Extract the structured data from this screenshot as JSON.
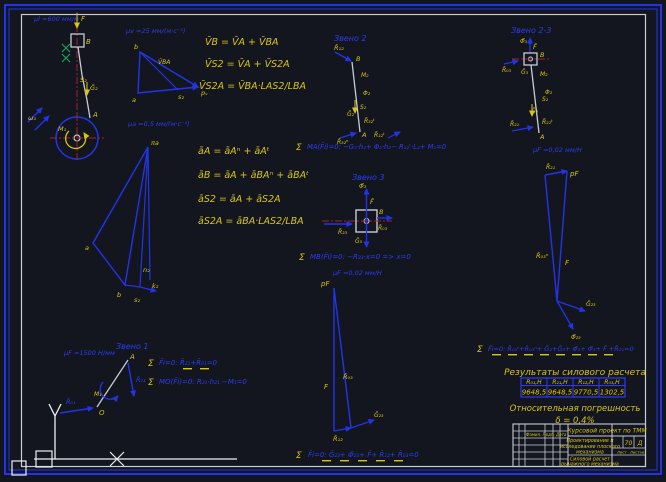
{
  "app": {
    "background": "#13161f",
    "accent_blue": "#2d3cf2",
    "accent_yellow": "#d9c41a"
  },
  "scales": {
    "mech": "μl =600 мм/м",
    "vel": "μv =25 мм/(м·с⁻¹)",
    "acc": "μa =0,5 мм/(м·с⁻²)",
    "link23": "μF =0,02 мм/Н",
    "poly23": "μF =0,02 мм/Н",
    "link1": "μF =1500 Н/мм"
  },
  "titles": {
    "link2": "Звено 2",
    "link3": "Звено 3",
    "link23": "Звено 2-3",
    "link1": "Звено 1"
  },
  "sym": {
    "sigma": "Σ"
  },
  "formulas": {
    "vel": [
      "V̄B = V̄A + V̄BA",
      "V̄S2 = V̄A + V̄S2A",
      "V̄S2A = V̄BA·LAS2/LBA"
    ],
    "acc": [
      "āA = āAⁿ + āAᵗ",
      "āB = āA + āBAⁿ + āBAᵗ",
      "āS2 = āA + āS2A",
      "āS2A = āBA·LAS2/LBA"
    ]
  },
  "equations": {
    "link2": "MA(F̄i)=0:  −G₂·h₂+ Φ₂·h₂− R₁₂ᵗ·L₂+ M₂=0",
    "link3": "MB(F̄i)=0:  −R₂₃·x=0  =>  x=0",
    "poly23": "F̄i=0:  Ḡ₂₃+ Φ̄₂₃+ F̄+ R̄₁₂+ R̄₀₃=0",
    "full": "F̄i=0:  R̄₀₃ᵗ+R̄₀₃ⁿ+ Ḡ₂+Ḡ₃+ Φ̄₂+ Φ̄₃+ F̄ +R̄₂₁=0",
    "link1_forces": "F̄i=0:  R̄₂₁+R̄₀₁=0",
    "link1_moments": "MO(F̄i)=0:  R₂₁·h₂₁ −M₁=0"
  },
  "labels": {
    "mech": {
      "F": "F",
      "B": "B",
      "S2": "S₂",
      "G2": "Ḡ₂",
      "A": "A",
      "omega": "ω₁",
      "M": "M₁"
    },
    "vel": {
      "b": "b",
      "a": "a",
      "s2": "s₂",
      "p": "pᵥ",
      "vba": "V̄BA"
    },
    "acc": {
      "pole": "πa",
      "a": "a",
      "b": "b",
      "s2": "s₂",
      "n": "n₂",
      "k": "k₂"
    },
    "link2": {
      "R12": "R̄₁₂",
      "B": "B",
      "M2": "M₂",
      "Phi2": "Φ₂",
      "S2": "S₂",
      "G2": "Ḡ₂",
      "R32t": "R̄₃₂ᵗ",
      "R32n": "R̄₃₂ⁿ",
      "A": "A",
      "R12t": "R̄₁₂ᵗ"
    },
    "link3": {
      "Phi3": "Φ̄₃",
      "F": "F̄",
      "B": "B",
      "R23": "R̄₂₃",
      "R03": "R̄₀₃",
      "G3": "Ḡ₃"
    },
    "link23": {
      "Phi3": "Φ̄₃",
      "F": "F̄",
      "B": "B",
      "R03": "R̄₀₃",
      "G3": "Ḡ₃",
      "M2": "M₂",
      "S2": "S₂",
      "Phi2": "Φ₂",
      "G2": "Ḡ₂",
      "R21t": "R̄₂₁ᵗ",
      "R21": "R̄₂₁",
      "A": "A"
    },
    "poly23": {
      "pole": "pF",
      "F": "F",
      "R03": "R̄₀₃",
      "R12": "R̄₁₂",
      "G23": "Ḡ₂₃"
    },
    "polyfull": {
      "pole": "pF",
      "R21": "R̄₂₁",
      "F": "F",
      "R03n": "R̄₀₃ⁿ",
      "G23": "Ḡ₂₃",
      "Phi23": "Φ̄₂₃"
    },
    "link1": {
      "A": "A",
      "O": "O",
      "R21": "R̄₂₁",
      "R01": "R̄₀₁",
      "M": "M₁"
    }
  },
  "results": {
    "title": "Результаты силового расчета",
    "headers": [
      "R₀₁,Н",
      "R₂₁,Н",
      "R₁₂,Н",
      "R₀₃,Н"
    ],
    "values": [
      "9648,5",
      "9648,5",
      "9770,5",
      "1302,5"
    ],
    "error_title": "Относительная погрешность",
    "error_value": "δ = 0,4%"
  },
  "titleblock": {
    "project": "Курсовой проект по ТММ",
    "subject1": "Проектирование и",
    "subject2": "исследование плоского",
    "subject3": "механизма",
    "doc1": "Силовой расчет",
    "doc2": "рычажного механизма",
    "mass": "70",
    "scale": "Д",
    "cols": "Фамил. Подп. Дата",
    "sheet_label": "Лист",
    "sheets_label": "Листов"
  }
}
